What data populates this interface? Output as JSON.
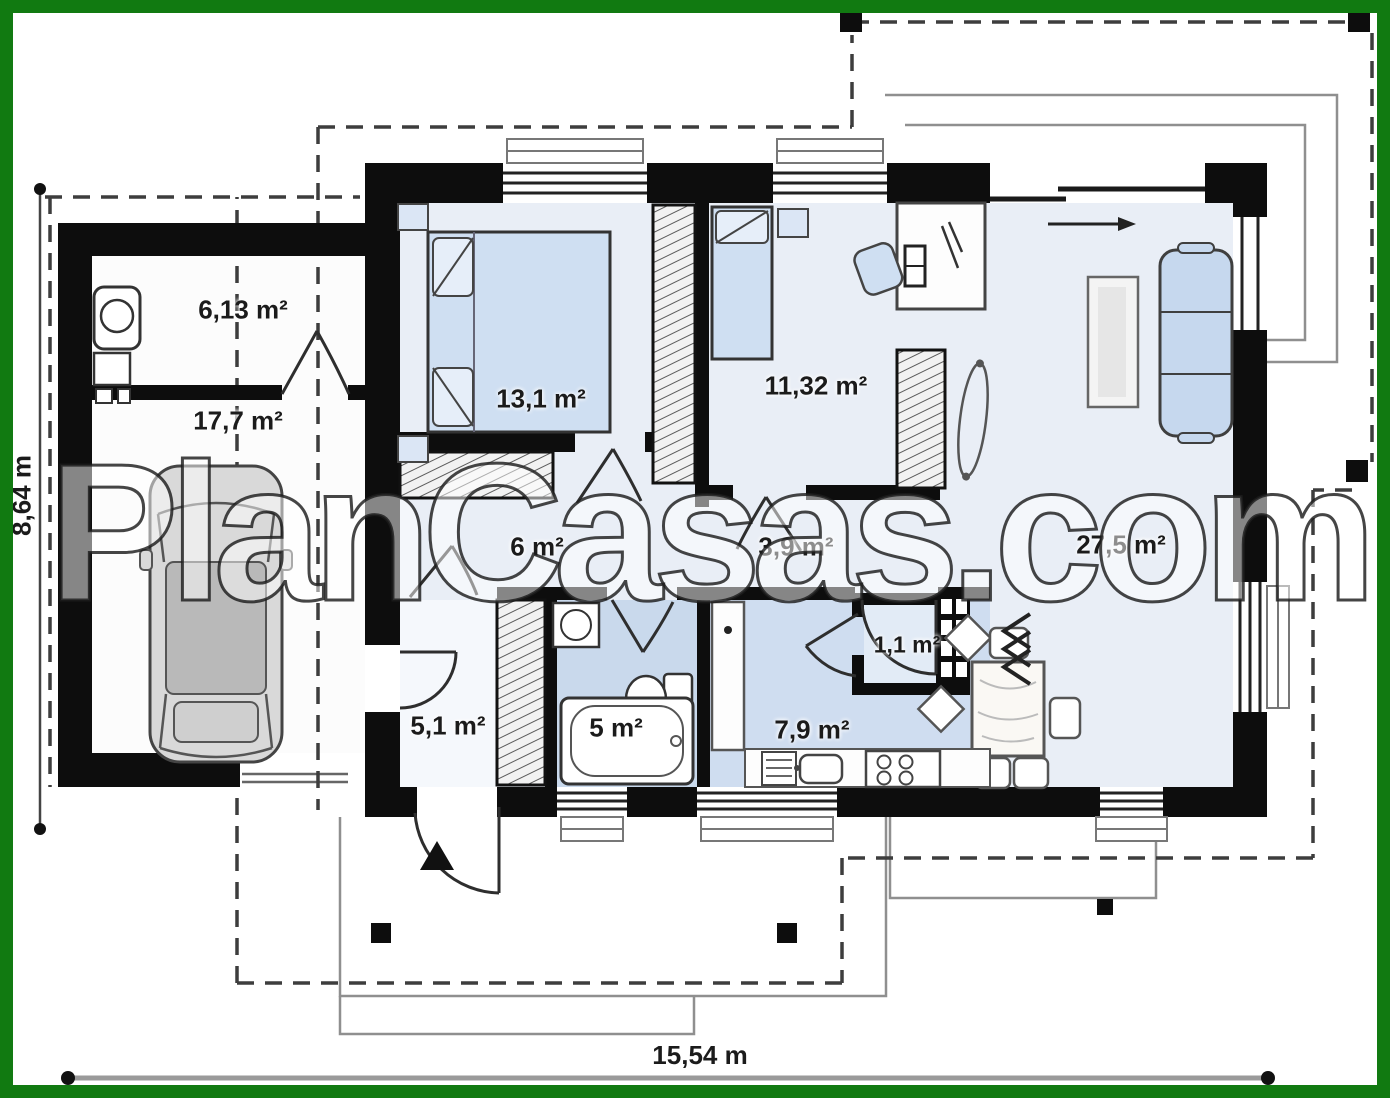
{
  "watermark": "PlanCasas.com",
  "dimensions": {
    "height_label": "8,64 m",
    "width_label": "15,54 m"
  },
  "rooms": [
    {
      "id": "storage",
      "label": "6,13 m²"
    },
    {
      "id": "garage",
      "label": "17,7 m²"
    },
    {
      "id": "bedroom-1",
      "label": "13,1 m²"
    },
    {
      "id": "bedroom-2",
      "label": "11,32 m²"
    },
    {
      "id": "hall",
      "label": "6 m²"
    },
    {
      "id": "corridor",
      "label": "3,9 m²"
    },
    {
      "id": "living-room",
      "label": "27,5 m²"
    },
    {
      "id": "entry",
      "label": "5,1 m²"
    },
    {
      "id": "bathroom",
      "label": "5 m²"
    },
    {
      "id": "pantry",
      "label": "1,1 m²"
    },
    {
      "id": "kitchen",
      "label": "7,9 m²"
    }
  ],
  "colors": {
    "frame_green": "#117a11",
    "wall_black": "#0d0d0d",
    "floor_light": "#e9eef6",
    "floor_wet": "#c9d9ec",
    "furniture_blue": "#cfdff2",
    "dashed_line": "#3d3d3d"
  }
}
